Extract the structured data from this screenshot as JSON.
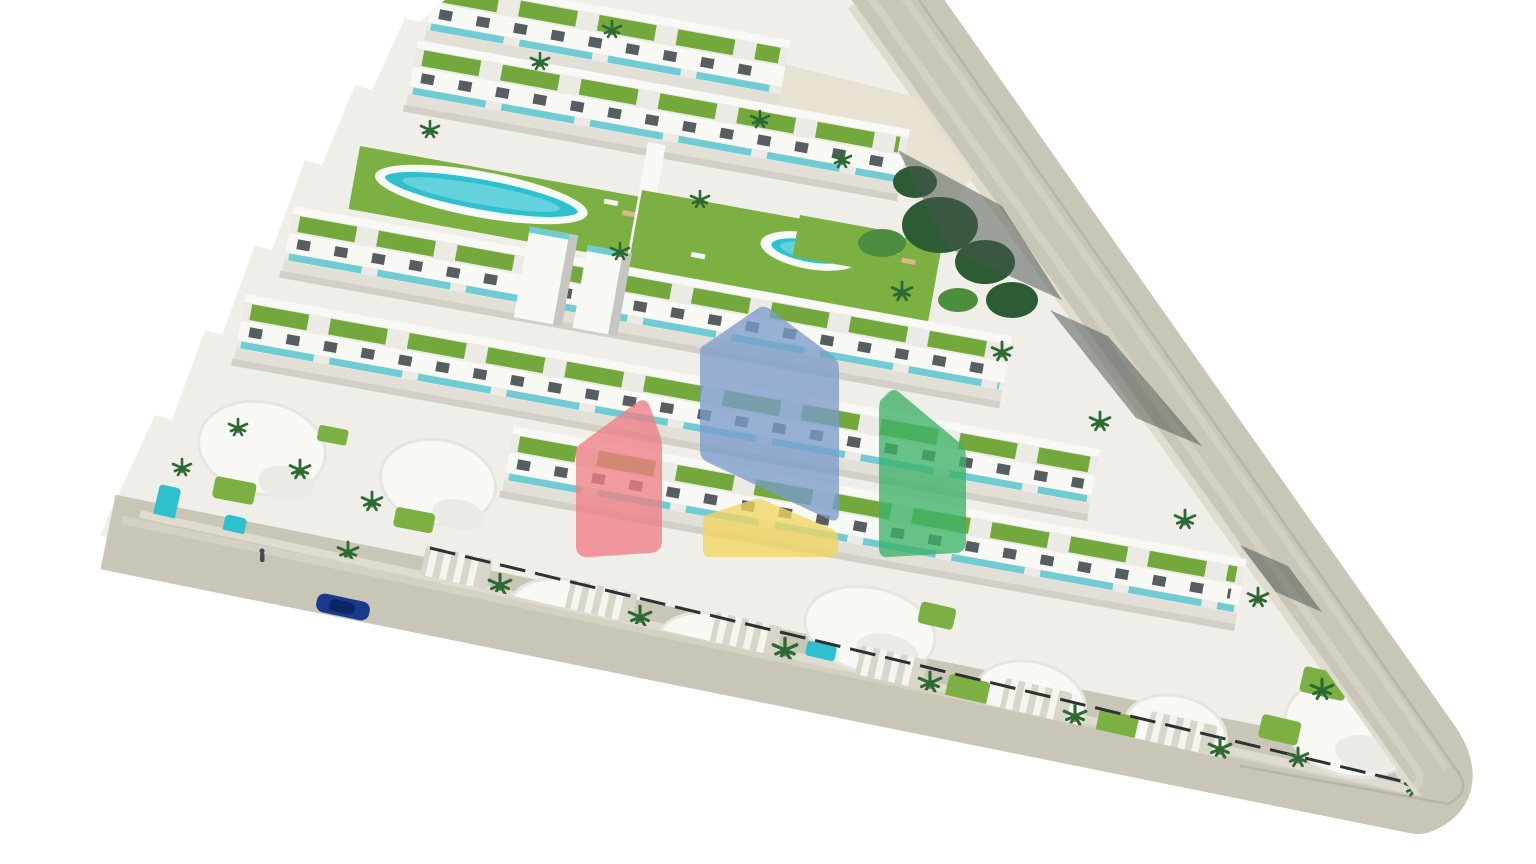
{
  "meta": {
    "description": "Aerial 3D architectural render of a triangular coastal residential development: terraced rows of white apartments with green roof gardens and teal glass balconies, two communal swimming pools on lawns, curved white villas with private pools and striped driveways along a perimeter road, palm trees, one dark-blue car on the road, one pedestrian, and a semi-transparent four-house watermark logo in the centre."
  },
  "colors": {
    "background": "#ffffff",
    "ground": "#efeee8",
    "road": "#c9c5b7",
    "road_stripe": "#d5d1c3",
    "road_edge": "#b5b0a1",
    "sidewalk": "#dfdccf",
    "path_sand": "#e7e0cf",
    "building_white": "#f8f8f5",
    "facade": "#eceae4",
    "facade_shadow": "#c6c5c0",
    "window": "#575e61",
    "glass": "#6fccd3",
    "terrace": "#e2dfd6",
    "row_shadow": "#c9c7bd",
    "lawn": "#7cb042",
    "roof_garden": "#73a93c",
    "tree_dark": "#2d5c34",
    "tree_mid": "#4c8e3e",
    "palm": "#2c6a33",
    "pool": "#2ec0cf",
    "pool_light": "#8fe0e8",
    "pool_rim": "#f4fbfa",
    "fence": "#2c3132",
    "shadow": "#47514e",
    "driveway": "#d8d5c9",
    "stripe_white": "#f5f4ef",
    "car_body": "#1a3a8e",
    "car_top": "#0c2663",
    "person": "#45494b",
    "lounger_tan": "#d9b98a"
  },
  "logo": {
    "opacity": "0.78",
    "houses": [
      {
        "name": "red-house",
        "color": "#ee7f87"
      },
      {
        "name": "blue-house",
        "color": "#7b9ccb"
      },
      {
        "name": "green-house",
        "color": "#3db269"
      },
      {
        "name": "yellow-house",
        "color": "#f1d660"
      }
    ]
  },
  "scene": {
    "communal_pools": 2,
    "apartment_rows": 6,
    "villas": 8,
    "driveways": 6,
    "cars": 1,
    "people": 1
  }
}
